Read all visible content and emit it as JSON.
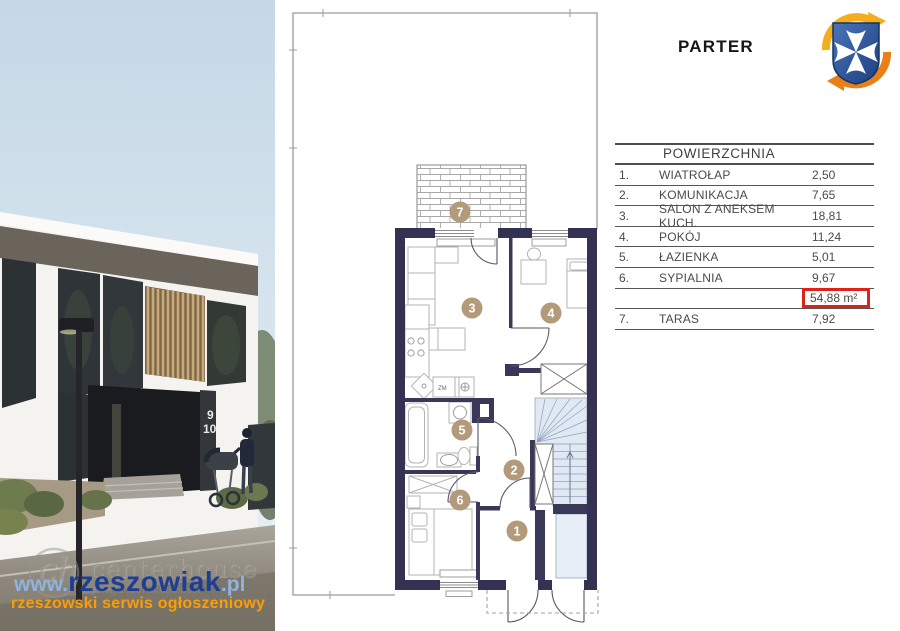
{
  "plan": {
    "title": "PARTER",
    "room_numbers": [
      "1",
      "2",
      "3",
      "4",
      "5",
      "6",
      "7"
    ],
    "kitchen_label": "ZM",
    "colors": {
      "exterior_wall": "#343253",
      "interior_wall": "#3a3858",
      "room_badge": "#b29a7b",
      "stairs_fill": "#dfe8f3",
      "plot_outline": "#9b9b9b"
    }
  },
  "table": {
    "header": "POWIERZCHNIA",
    "rows": [
      {
        "no": "1.",
        "name": "WIATROŁAP",
        "value": "2,50"
      },
      {
        "no": "2.",
        "name": "KOMUNIKACJA",
        "value": "7,65"
      },
      {
        "no": "3.",
        "name": "SALON Z ANEKSEM KUCH.",
        "value": "18,81"
      },
      {
        "no": "4.",
        "name": "POKÓJ",
        "value": "11,24"
      },
      {
        "no": "5.",
        "name": "ŁAZIENKA",
        "value": "5,01"
      },
      {
        "no": "6.",
        "name": "SYPIALNIA",
        "value": "9,67"
      },
      {
        "no": "",
        "name": "",
        "value": "54,88 m²"
      },
      {
        "no": "7.",
        "name": "TARAS",
        "value": "7,92"
      }
    ],
    "total_highlight_color": "#de221a"
  },
  "logo": {
    "name": "rzeszow-coat-of-arms",
    "shield_color": "#2c55a0",
    "cross_color": "#ffffff",
    "arrow_top_color": "#f3ae1e",
    "arrow_bottom_color": "#e97f16"
  },
  "photo": {
    "unit_numbers": [
      "9",
      "10"
    ],
    "watermarks": {
      "agency_initials": "ch",
      "agency_name": "centerhouse",
      "agency_subtitle": "agencja nieruchomości",
      "url_prefix": "www.",
      "url_main": "rzeszowiak",
      "url_suffix": ".pl",
      "tagline": "rzeszowski serwis ogłoszeniowy",
      "url_main_color": "#1e3e96",
      "url_accent_color": "#8fb3e0",
      "tagline_color": "#ff9d00"
    }
  }
}
